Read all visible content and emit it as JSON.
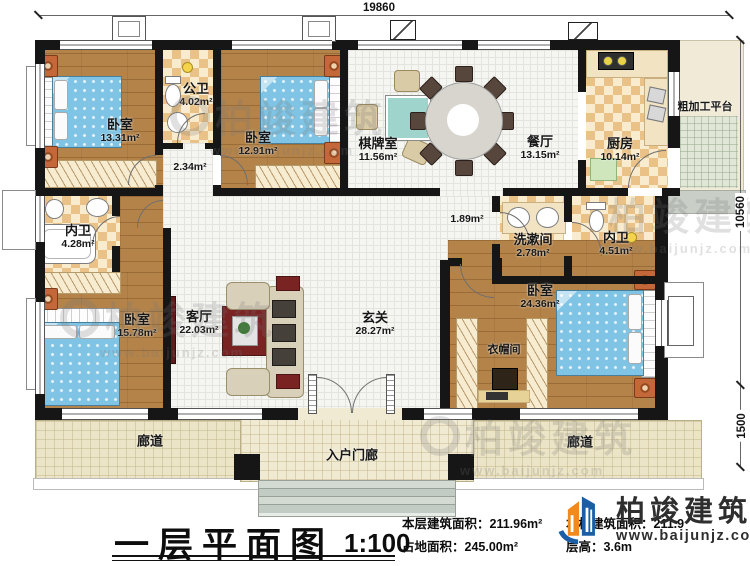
{
  "plan_title": "一层平面图",
  "rooms": [
    {
      "name": "卧室",
      "area": "13.31m²"
    },
    {
      "name": "公卫",
      "area": "4.02m²"
    },
    {
      "name": "",
      "area": "2.34m²"
    },
    {
      "name": "卧室",
      "area": "12.91m²"
    },
    {
      "name": "棋牌室",
      "area": "11.56m²"
    },
    {
      "name": "餐厅",
      "area": "13.15m²"
    },
    {
      "name": "厨房",
      "area": "10.14m²"
    },
    {
      "name": "粗加工平台",
      "area": ""
    },
    {
      "name": "内卫",
      "area": "4.28m²"
    },
    {
      "name": "洗漱间",
      "area": "2.78m²"
    },
    {
      "name": "内卫",
      "area": "4.51m²"
    },
    {
      "name": "",
      "area": "1.89m²"
    },
    {
      "name": "卧室",
      "area": "15.78m²"
    },
    {
      "name": "客厅",
      "area": "22.03m²"
    },
    {
      "name": "玄关",
      "area": "28.27m²"
    },
    {
      "name": "卧室",
      "area": "24.36m²"
    },
    {
      "name": "衣帽间",
      "area": ""
    },
    {
      "name": "廊道",
      "area": ""
    },
    {
      "name": "廊道",
      "area": ""
    },
    {
      "name": "入户门廊",
      "area": ""
    }
  ],
  "dimensions": {
    "top": "19860",
    "right_upper": "10560",
    "right_lower": "1500"
  },
  "title_block": {
    "title": "一层平面图",
    "scale": "1:100",
    "stat1_label": "本层建筑面积：",
    "stat1_value": "211.96m²",
    "stat2_label": "占地面积：",
    "stat2_value": "245.00m²",
    "stat3_label": "本栋建筑面积：",
    "stat3_value": "211.9",
    "stat4_label": "层高：",
    "stat4_value": "3.6m"
  },
  "brand": {
    "name": "柏竣建筑",
    "url": "www.baijunjz.com"
  },
  "watermark": {
    "name": "柏竣建筑",
    "url": "www.baijunjz.com"
  },
  "colors": {
    "wall": "#161616",
    "wood_floor": "#b3834a",
    "tile": "#eac287",
    "bed": "#7fc4e4",
    "corridor": "#ebe4c6",
    "accent_red": "#7a2323",
    "brand_blue": "#1b5ea6",
    "brand_orange": "#f08a1d"
  }
}
